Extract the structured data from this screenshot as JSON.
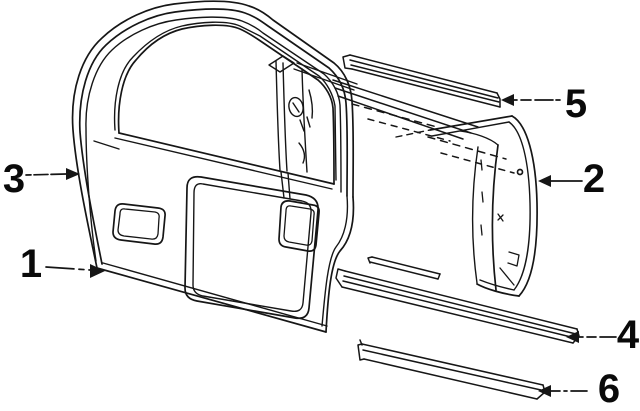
{
  "diagram": {
    "background_color": "#ffffff",
    "line_color": "#161616",
    "label_color": "#0a0a0a",
    "callouts": [
      {
        "label": "1",
        "arrow_direction": "right"
      },
      {
        "label": "2",
        "arrow_direction": "left"
      },
      {
        "label": "3",
        "arrow_direction": "right"
      },
      {
        "label": "4",
        "arrow_direction": "left"
      },
      {
        "label": "5",
        "arrow_direction": "left"
      },
      {
        "label": "6",
        "arrow_direction": "left"
      }
    ],
    "icons": {
      "arrowhead_left": "◀",
      "arrowhead_right": "▶"
    }
  }
}
